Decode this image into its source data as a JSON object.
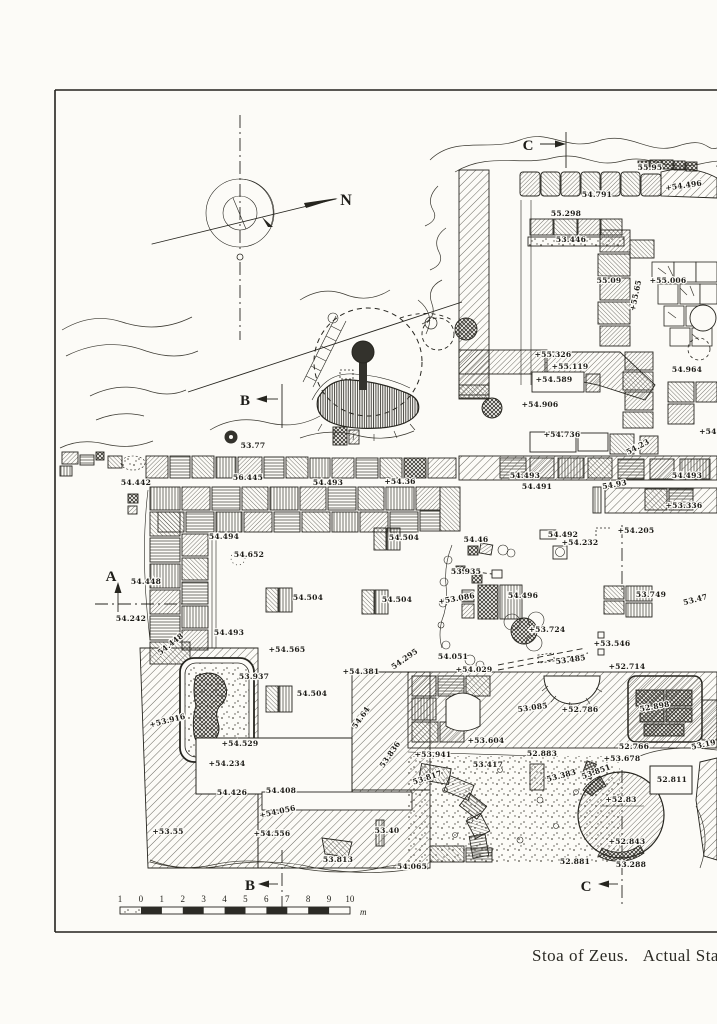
{
  "page": {
    "background": "#fcfbf7",
    "ink": "#26251f"
  },
  "caption": {
    "title": "Stoa of Zeus.",
    "state": "Actual State"
  },
  "compass": {
    "north_label": "N"
  },
  "section_markers": [
    {
      "label": "N",
      "x": 346,
      "y": 205,
      "size": 16
    },
    {
      "label": "C",
      "x": 528,
      "y": 150,
      "size": 15
    },
    {
      "label": "B",
      "x": 245,
      "y": 405,
      "size": 15
    },
    {
      "label": "A",
      "x": 111,
      "y": 581,
      "size": 15
    },
    {
      "label": "B",
      "x": 250,
      "y": 890,
      "size": 15
    },
    {
      "label": "C",
      "x": 586,
      "y": 891,
      "size": 15
    }
  ],
  "scale_bar": {
    "ticks": [
      "1",
      "0",
      "1",
      "2",
      "3",
      "4",
      "5",
      "6",
      "7",
      "8",
      "9",
      "10"
    ],
    "unit": "m"
  },
  "elevations": [
    {
      "t": "54.791",
      "x": 597,
      "y": 197
    },
    {
      "t": "55.298",
      "x": 566,
      "y": 216
    },
    {
      "t": "53.446",
      "x": 571,
      "y": 242
    },
    {
      "t": "55.95",
      "x": 650,
      "y": 170
    },
    {
      "t": "+54.496",
      "x": 684,
      "y": 188,
      "r": -8
    },
    {
      "t": "55.09",
      "x": 609,
      "y": 283
    },
    {
      "t": "+55.006",
      "x": 668,
      "y": 283
    },
    {
      "t": "+55.65",
      "x": 638,
      "y": 296,
      "r": -78
    },
    {
      "t": "+55.326",
      "x": 553,
      "y": 357
    },
    {
      "t": "+55.119",
      "x": 570,
      "y": 369
    },
    {
      "t": "+54.589",
      "x": 554,
      "y": 382
    },
    {
      "t": "54.964",
      "x": 687,
      "y": 372
    },
    {
      "t": "+54.906",
      "x": 540,
      "y": 407
    },
    {
      "t": "+54.736",
      "x": 562,
      "y": 437
    },
    {
      "t": "54.23",
      "x": 639,
      "y": 449,
      "r": -28
    },
    {
      "t": "+54.8",
      "x": 712,
      "y": 434
    },
    {
      "t": "54.493",
      "x": 525,
      "y": 478
    },
    {
      "t": "54.491",
      "x": 537,
      "y": 489
    },
    {
      "t": "54.93",
      "x": 615,
      "y": 487,
      "r": -10
    },
    {
      "t": "54.493",
      "x": 687,
      "y": 478
    },
    {
      "t": "+53.336",
      "x": 684,
      "y": 508
    },
    {
      "t": "+54.205",
      "x": 636,
      "y": 533
    },
    {
      "t": "54.442",
      "x": 136,
      "y": 485
    },
    {
      "t": "56.445",
      "x": 248,
      "y": 480
    },
    {
      "t": "54.493",
      "x": 328,
      "y": 485
    },
    {
      "t": "+54.36",
      "x": 400,
      "y": 484
    },
    {
      "t": "53.77",
      "x": 253,
      "y": 448
    },
    {
      "t": "54.494",
      "x": 224,
      "y": 539
    },
    {
      "t": "54.652",
      "x": 249,
      "y": 557
    },
    {
      "t": "54.448",
      "x": 146,
      "y": 584
    },
    {
      "t": "54.242",
      "x": 131,
      "y": 621
    },
    {
      "t": "54.504",
      "x": 404,
      "y": 540
    },
    {
      "t": "54.504",
      "x": 308,
      "y": 600
    },
    {
      "t": "54.504",
      "x": 397,
      "y": 602
    },
    {
      "t": "54.493",
      "x": 229,
      "y": 635
    },
    {
      "t": "54.448",
      "x": 172,
      "y": 646,
      "r": -38
    },
    {
      "t": "+54.565",
      "x": 287,
      "y": 652
    },
    {
      "t": "53.937",
      "x": 254,
      "y": 679
    },
    {
      "t": "54.504",
      "x": 312,
      "y": 696
    },
    {
      "t": "+53.916",
      "x": 168,
      "y": 723,
      "r": -14
    },
    {
      "t": "+54.529",
      "x": 240,
      "y": 746
    },
    {
      "t": "+54.234",
      "x": 227,
      "y": 766
    },
    {
      "t": "54.426",
      "x": 232,
      "y": 795
    },
    {
      "t": "54.408",
      "x": 281,
      "y": 793
    },
    {
      "t": "+54.056",
      "x": 278,
      "y": 814,
      "r": -12
    },
    {
      "t": "+53.55",
      "x": 168,
      "y": 834
    },
    {
      "t": "+54.556",
      "x": 272,
      "y": 836
    },
    {
      "t": "53.40",
      "x": 387,
      "y": 833
    },
    {
      "t": "53.813",
      "x": 338,
      "y": 862
    },
    {
      "t": "54.065",
      "x": 412,
      "y": 869
    },
    {
      "t": "54.46",
      "x": 476,
      "y": 542
    },
    {
      "t": "54.492",
      "x": 563,
      "y": 537
    },
    {
      "t": "+54.232",
      "x": 580,
      "y": 545
    },
    {
      "t": "53.935",
      "x": 466,
      "y": 574
    },
    {
      "t": "+53.086",
      "x": 457,
      "y": 601,
      "r": -10
    },
    {
      "t": "54.496",
      "x": 523,
      "y": 598
    },
    {
      "t": "+53.724",
      "x": 547,
      "y": 632
    },
    {
      "t": "53.749",
      "x": 651,
      "y": 597
    },
    {
      "t": "53.47",
      "x": 696,
      "y": 602,
      "r": -15
    },
    {
      "t": "+53.546",
      "x": 612,
      "y": 646
    },
    {
      "t": "54.051",
      "x": 453,
      "y": 659
    },
    {
      "t": "+54.029",
      "x": 474,
      "y": 672
    },
    {
      "t": "53.485",
      "x": 571,
      "y": 662,
      "r": -8
    },
    {
      "t": "+52.714",
      "x": 627,
      "y": 669
    },
    {
      "t": "54.295",
      "x": 406,
      "y": 661,
      "r": -35
    },
    {
      "t": "+54.381",
      "x": 361,
      "y": 674
    },
    {
      "t": "54.64",
      "x": 363,
      "y": 719,
      "r": -55
    },
    {
      "t": "53.836",
      "x": 392,
      "y": 756,
      "r": -55
    },
    {
      "t": "+53.604",
      "x": 486,
      "y": 743
    },
    {
      "t": "53.085",
      "x": 533,
      "y": 710,
      "r": -8
    },
    {
      "t": "+52.786",
      "x": 580,
      "y": 712
    },
    {
      "t": "52.898",
      "x": 655,
      "y": 709,
      "r": -10
    },
    {
      "t": "52.766",
      "x": 634,
      "y": 749
    },
    {
      "t": "53.19",
      "x": 704,
      "y": 747,
      "r": -12
    },
    {
      "t": "+53.941",
      "x": 433,
      "y": 757
    },
    {
      "t": "52.883",
      "x": 542,
      "y": 756
    },
    {
      "t": "+53.678",
      "x": 622,
      "y": 761
    },
    {
      "t": "53.417",
      "x": 488,
      "y": 767
    },
    {
      "t": "53.817",
      "x": 428,
      "y": 780,
      "r": -18
    },
    {
      "t": "53.383",
      "x": 562,
      "y": 778,
      "r": -15
    },
    {
      "t": "53.851",
      "x": 597,
      "y": 774,
      "r": -20
    },
    {
      "t": "52.811",
      "x": 672,
      "y": 782
    },
    {
      "t": "+52.83",
      "x": 621,
      "y": 802
    },
    {
      "t": "+52.843",
      "x": 627,
      "y": 844
    },
    {
      "t": "52.881",
      "x": 575,
      "y": 864
    },
    {
      "t": "53.288",
      "x": 631,
      "y": 867
    }
  ]
}
